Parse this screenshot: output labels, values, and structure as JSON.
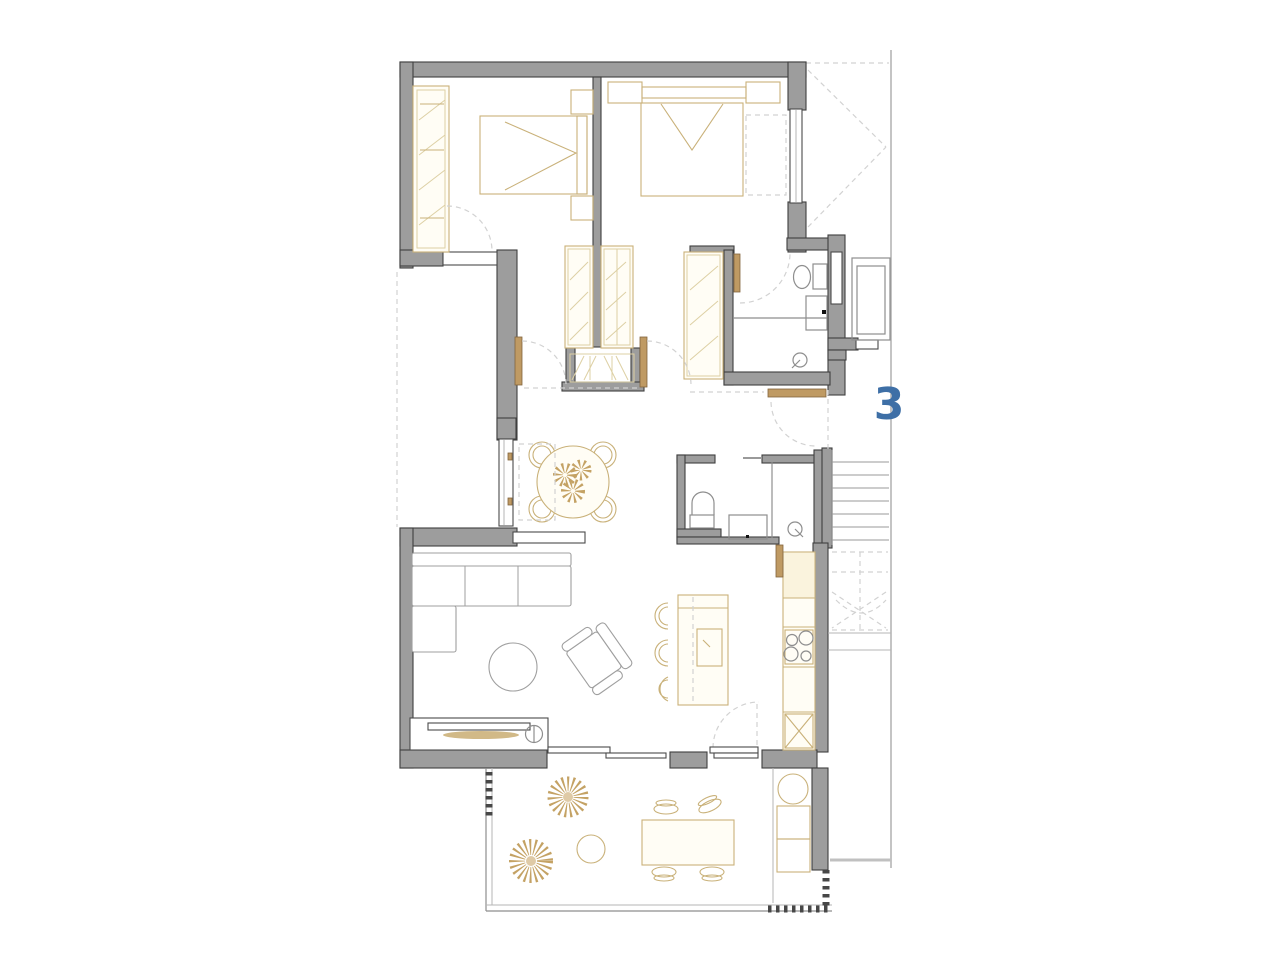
{
  "plan": {
    "unit_label": "3",
    "kind": "apartment-floor-plan",
    "rooms": [
      "bedroom-1",
      "bedroom-2",
      "bathroom-1",
      "bathroom-2",
      "hallway",
      "dining-area",
      "living-room",
      "kitchen",
      "terrace",
      "staircase",
      "elevator"
    ]
  },
  "theme": {
    "background": "#ffffff",
    "wall_fill": "#9d9d9d",
    "wall_outline": "#3f3f3f",
    "furniture_line": "#c9b179",
    "furniture_dark": "#bf9a63",
    "detail_line": "#8e8e8e",
    "dashed_line": "#d2d2d2",
    "accent_blue": "#3e6fa6"
  }
}
